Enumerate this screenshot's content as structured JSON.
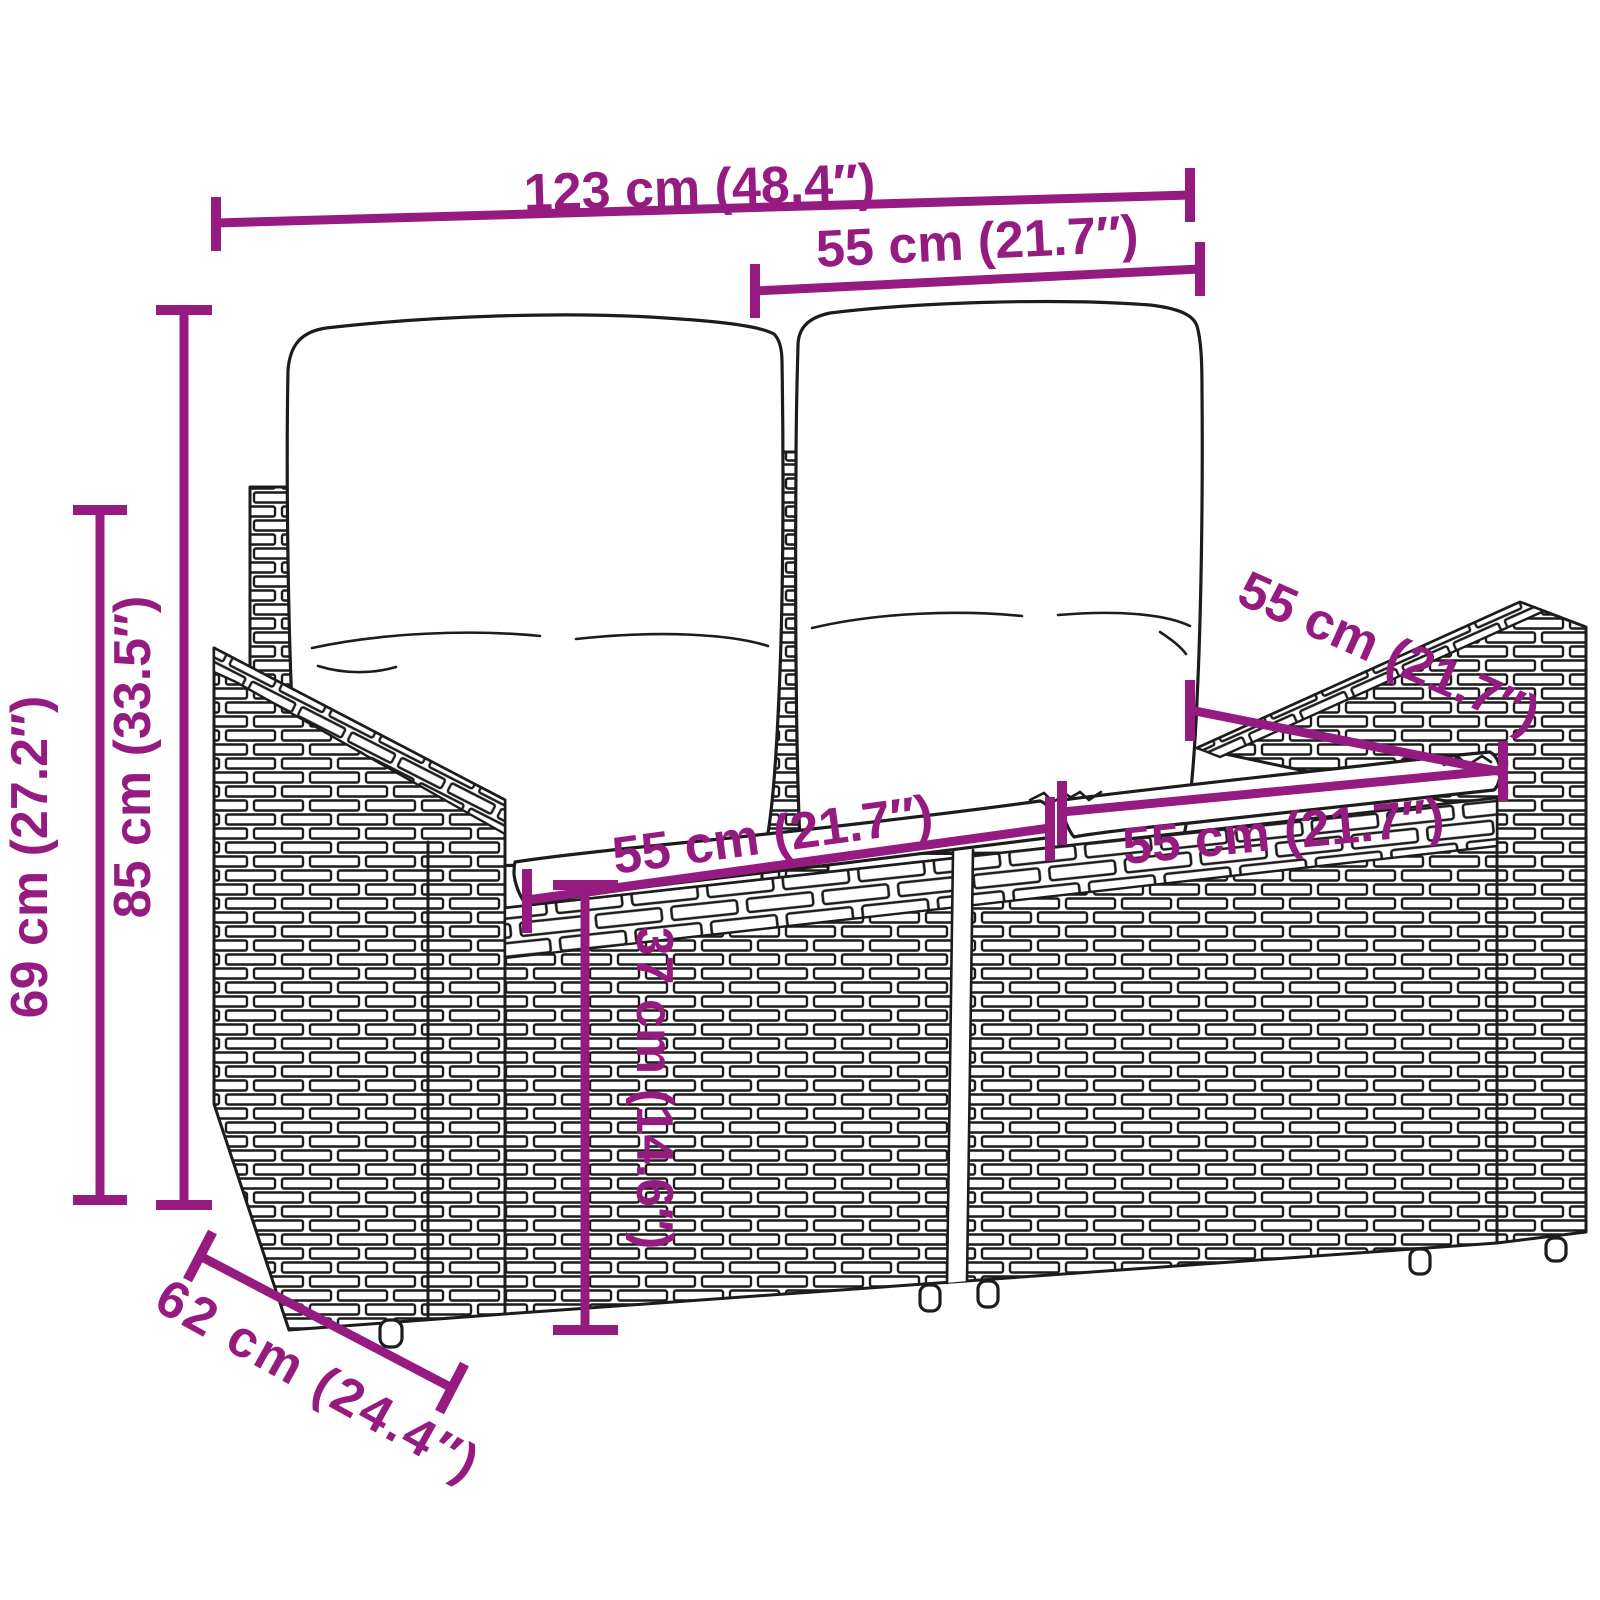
{
  "meta": {
    "background_color": "#ffffff",
    "accent_color": "#951b81",
    "line_color": "#1c1c1c"
  },
  "diagram": {
    "kind": "product-dimension-diagram",
    "subject": "2-seater poly rattan garden sofa with back and seat cushions",
    "units": [
      "cm",
      "inches"
    ],
    "dimensions": [
      {
        "id": "overall-width",
        "label": "123 cm (48.4″)"
      },
      {
        "id": "backrest-cushion-width",
        "label": "55 cm (21.7″)"
      },
      {
        "id": "overall-height",
        "label": "85 cm (33.5″)"
      },
      {
        "id": "frame-height",
        "label": "69 cm (27.2″)"
      },
      {
        "id": "seat-width-left",
        "label": "55 cm (21.7″)"
      },
      {
        "id": "seat-width-right",
        "label": "55 cm (21.7″)"
      },
      {
        "id": "seat-depth",
        "label": "55 cm (21.7″)"
      },
      {
        "id": "seat-height",
        "label": "37 cm (14.6″)"
      },
      {
        "id": "overall-depth",
        "label": "62 cm (24.4″)"
      }
    ]
  }
}
